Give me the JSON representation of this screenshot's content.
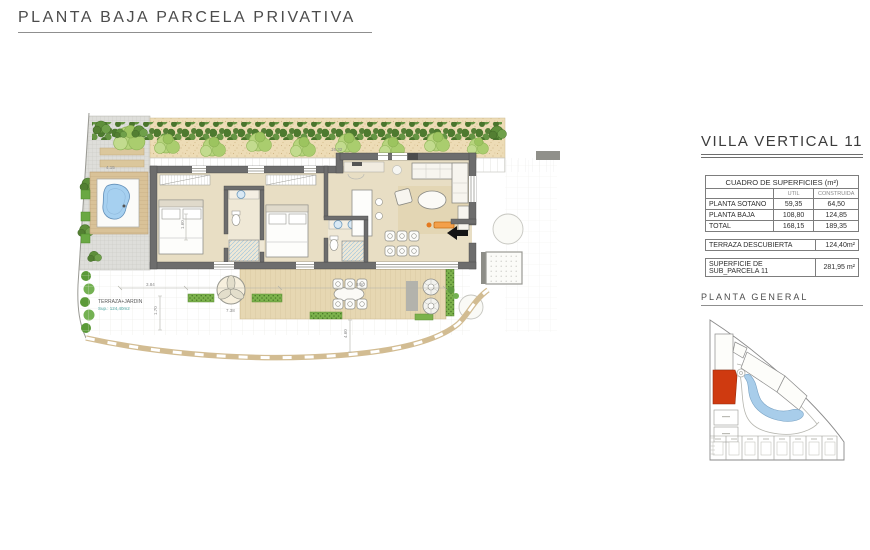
{
  "page": {
    "title": "PLANTA BAJA PARCELA PRIVATIVA"
  },
  "sidebar": {
    "title": "VILLA VERTICAL 11",
    "surfaces_table": {
      "header": "CUADRO DE SUPERFICIES (m²)",
      "col_headers": [
        "UTIL",
        "CONSTRUIDA"
      ],
      "rows": [
        {
          "label": "PLANTA SOTANO",
          "util": "59,35",
          "construida": "64,50"
        },
        {
          "label": "PLANTA BAJA",
          "util": "108,80",
          "construida": "124,85"
        },
        {
          "label": "TOTAL",
          "util": "168,15",
          "construida": "189,35"
        }
      ]
    },
    "terraza_row": {
      "label": "TERRAZA DESCUBIERTA",
      "value": "124,40m²"
    },
    "parcela_row": {
      "label": "SUPERFICIE DE SUB_PARCELA 11",
      "value": "281,95 m²"
    },
    "site_plan_title": "PLANTA GENERAL"
  },
  "plan": {
    "labels": {
      "terraza_jardin": "TERRAZA+JARDIN",
      "terraza_sup": "Sup.: 124,40m2"
    },
    "dimensions": {
      "walkway": "16.32",
      "pavers": "4.15",
      "terrace_a": "3.84",
      "terrace_b": "7.38",
      "terrace_c": "8.50",
      "vert_a": "1.70",
      "vert_b": "1.60",
      "vert_c": "4.60"
    }
  },
  "colors": {
    "accent_orange": "#cf3a10",
    "bench_orange": "#f3a04a",
    "wall_gray": "#6d6d6d",
    "floor_beige": "#e8dec4",
    "deck_tan": "#d9c298",
    "gravel_tan": "#eddcb6",
    "pool_blue": "#a6d0f0",
    "lake_blue": "#a8cdea",
    "hedge_green": "#4d7a2f",
    "shrub_green": "#6aa843"
  },
  "icons": {
    "entry_arrow": "entry-direction-arrow"
  }
}
